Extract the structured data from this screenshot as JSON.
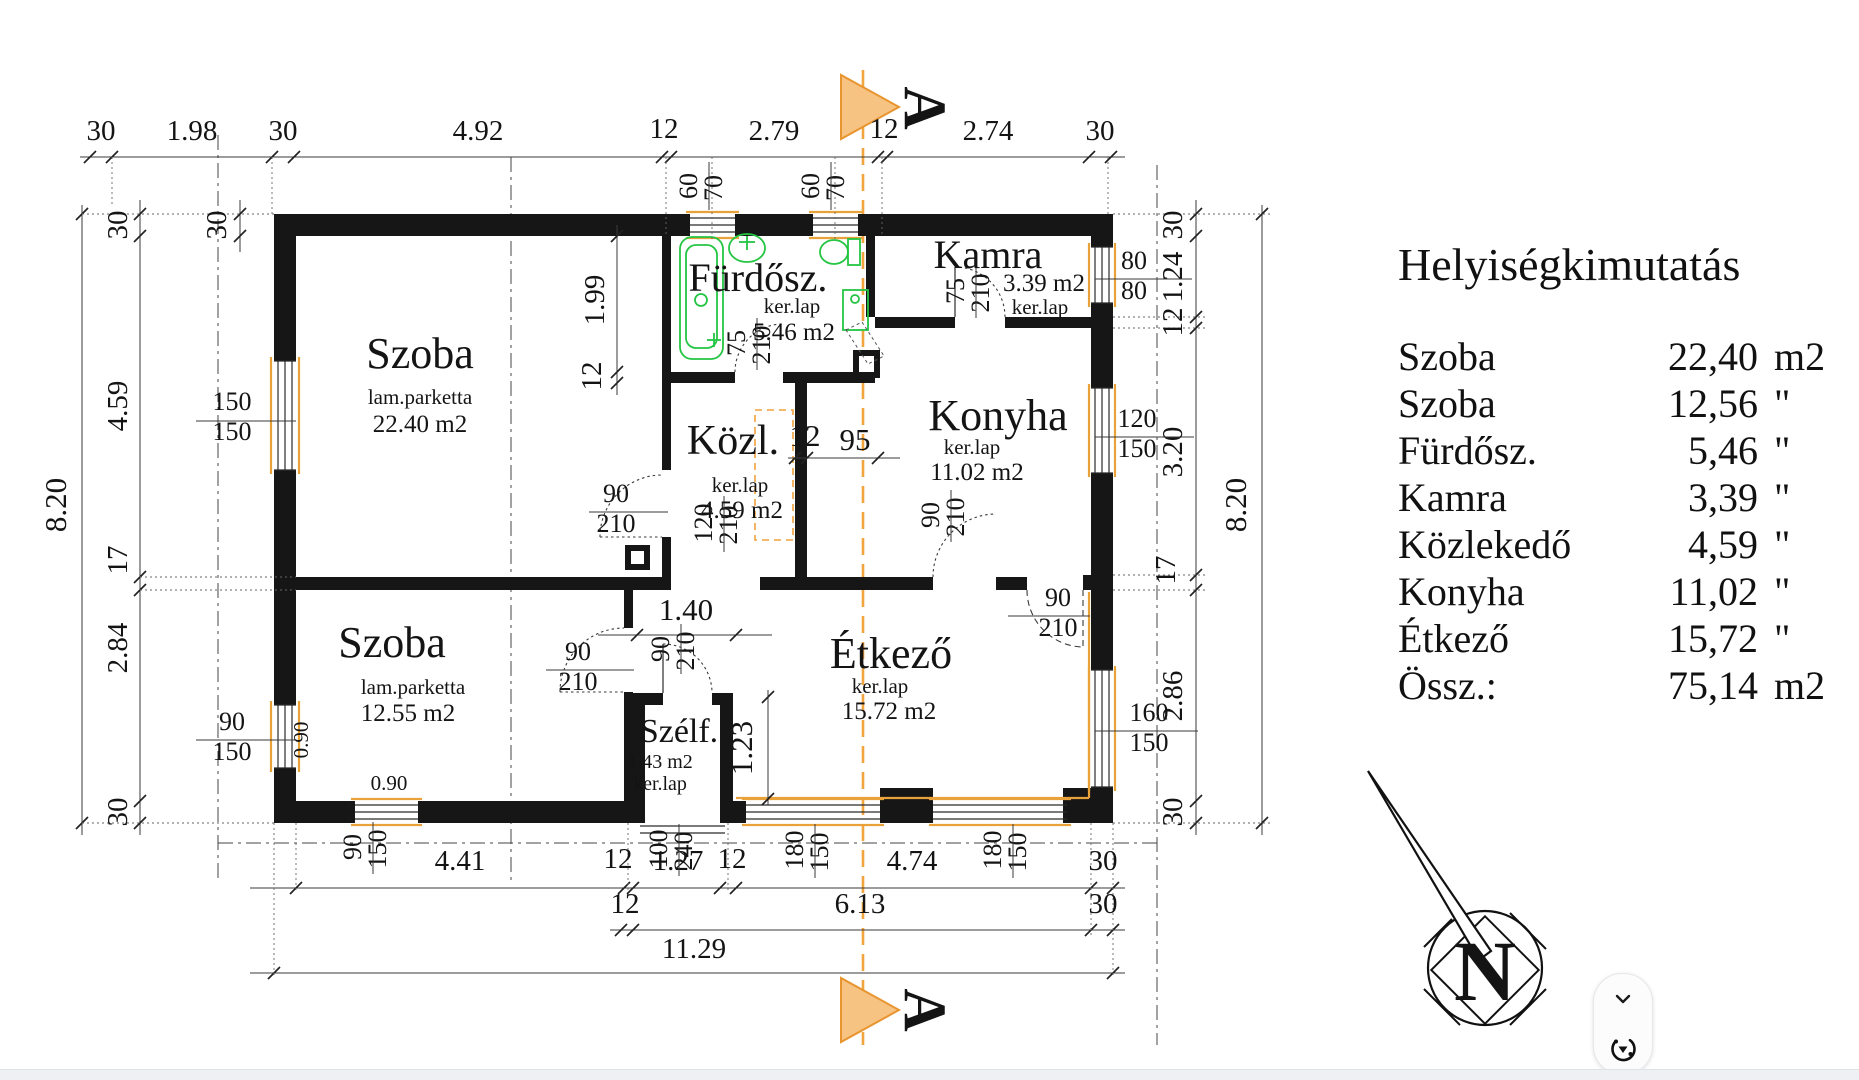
{
  "schedule": {
    "title": "Helyiségkimutatás",
    "rows": [
      {
        "name": "Szoba",
        "value": "22,40",
        "unit": "m2"
      },
      {
        "name": "Szoba",
        "value": "12,56",
        "unit": "\""
      },
      {
        "name": "Fürdősz.",
        "value": "5,46",
        "unit": "\""
      },
      {
        "name": "Kamra",
        "value": "3,39",
        "unit": "\""
      },
      {
        "name": "Közlekedő",
        "value": "4,59",
        "unit": "\""
      },
      {
        "name": "Konyha",
        "value": "11,02",
        "unit": "\""
      },
      {
        "name": "Étkező",
        "value": "15,72",
        "unit": "\""
      },
      {
        "name": "Össz.:",
        "value": "75,14",
        "unit": "m2"
      }
    ]
  },
  "rooms": {
    "szoba1": {
      "name": "Szoba",
      "floor": "lam.parketta",
      "area": "22.40 m2"
    },
    "szoba2": {
      "name": "Szoba",
      "floor": "lam.parketta",
      "area": "12.55 m2"
    },
    "furdosz": {
      "name": "Fürdősz.",
      "floor": "ker.lap",
      "area": "5.46 m2"
    },
    "kamra": {
      "name": "Kamra",
      "floor": "ker.lap",
      "area": "3.39 m2"
    },
    "kozl": {
      "name": "Közl.",
      "floor": "ker.lap",
      "area": "4.59 m2"
    },
    "konyha": {
      "name": "Konyha",
      "floor": "ker.lap",
      "area": "11.02 m2"
    },
    "etkezo": {
      "name": "Étkező",
      "floor": "ker.lap",
      "area": "15.72 m2"
    },
    "szelf": {
      "name": "Szélf.",
      "floor": "ker.lap",
      "area": "1.43 m2"
    }
  },
  "dims": {
    "top": [
      "30",
      "1.98",
      "30",
      "4.92",
      "12",
      "2.79",
      "12",
      "2.74",
      "30"
    ],
    "bottom1": [
      "4.41",
      "12",
      "1.27",
      "12",
      "4.74",
      "30"
    ],
    "bottom2": [
      "12",
      "6.13",
      "30"
    ],
    "bottom3": "11.29",
    "left": [
      "30",
      "4.59",
      "17",
      "2.84",
      "30"
    ],
    "left_total": "8.20",
    "right": [
      "30",
      "1.24",
      "12",
      "3.20",
      "17",
      "2.86",
      "30"
    ],
    "right_total": "8.20",
    "corner": "30",
    "bath_h": "1.99",
    "bath_wall": "12",
    "pass": [
      "12",
      "95"
    ],
    "hall_w": "1.40",
    "szelf_h": "1.23",
    "sill_v": "0.90",
    "sill_h": "0.90"
  },
  "openings": {
    "w_szoba1": [
      "150",
      "150"
    ],
    "w_szoba2l": [
      "90",
      "150"
    ],
    "w_szoba2b": [
      "90",
      "150"
    ],
    "w_kamra": [
      "80",
      "80"
    ],
    "w_konyha": [
      "120",
      "150"
    ],
    "w_etk_r": [
      "160",
      "150"
    ],
    "w_etk_b1": [
      "180",
      "150"
    ],
    "w_etk_b2": [
      "180",
      "150"
    ],
    "w_bath1": [
      "60",
      "70"
    ],
    "w_bath2": [
      "60",
      "70"
    ],
    "d_entry": [
      "100",
      "240"
    ],
    "d_szoba1": [
      "90",
      "210"
    ],
    "d_szoba2": [
      "90",
      "210"
    ],
    "d_hall": [
      "90",
      "210"
    ],
    "d_konyha": [
      "90",
      "210"
    ],
    "d_etk": [
      "90",
      "210"
    ],
    "d_bath": [
      "75",
      "210"
    ],
    "d_kamra": [
      "75",
      "210"
    ],
    "d_kozl": [
      "120",
      "210"
    ]
  },
  "section": {
    "marker_top": "A",
    "marker_bottom": "A"
  },
  "compass": {
    "letter": "N"
  },
  "colors": {
    "section_orange": "#f2a43e",
    "fixture_green": "#25c544",
    "wall_black": "#161616"
  }
}
